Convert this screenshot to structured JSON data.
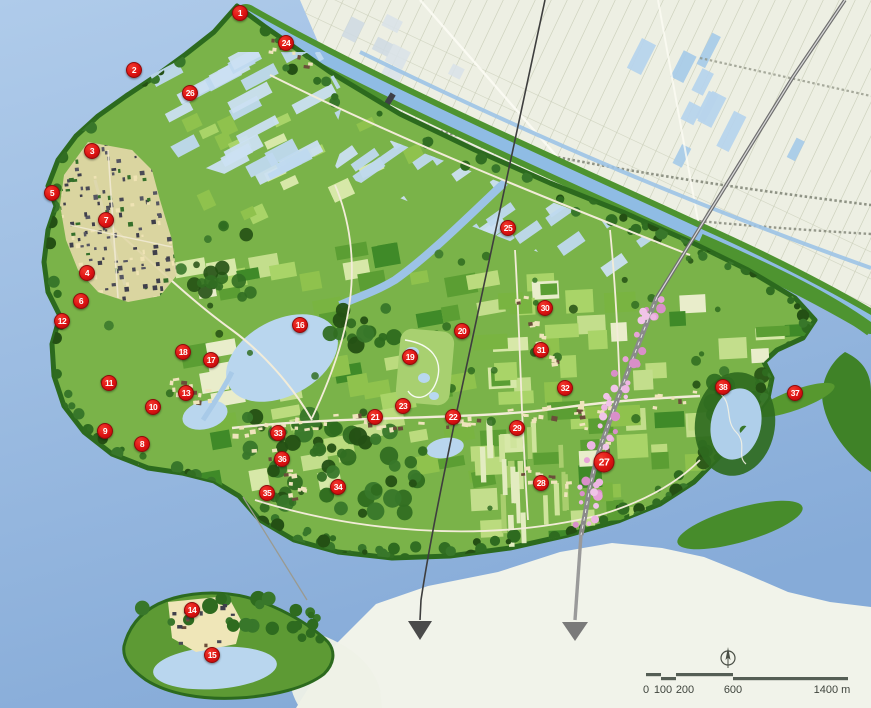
{
  "map": {
    "colors": {
      "sea_top": "#AFCBEA",
      "sea_bottom": "#86ABD8",
      "sand_flat": "#F1F3EA",
      "polder": "#EDEFE3",
      "polder_line": "#C9CDB8",
      "island_green": "#7AB349",
      "field_dark_green": "#3F8A28",
      "forest_green": "#2E6B1F",
      "canal_bank_green": "#4E9430",
      "water_parcel_blue": "#BFD9EF",
      "lake_blue": "#B9D6EE",
      "town_dark": "#4A4A55",
      "village_cream": "#EFE4BC",
      "road_gray": "#8A8A8A",
      "blossom_pink": "#E9A8DB",
      "marker_red": "#DD1212"
    },
    "markers": [
      {
        "label": "1",
        "x": 240,
        "y": 13
      },
      {
        "label": "2",
        "x": 134,
        "y": 70
      },
      {
        "label": "3",
        "x": 92,
        "y": 151
      },
      {
        "label": "4",
        "x": 87,
        "y": 273
      },
      {
        "label": "5",
        "x": 52,
        "y": 193
      },
      {
        "label": "6",
        "x": 81,
        "y": 301
      },
      {
        "label": "7",
        "x": 106,
        "y": 220
      },
      {
        "label": "8",
        "x": 142,
        "y": 444
      },
      {
        "label": "9",
        "x": 105,
        "y": 431
      },
      {
        "label": "10",
        "x": 153,
        "y": 407
      },
      {
        "label": "11",
        "x": 109,
        "y": 383
      },
      {
        "label": "12",
        "x": 62,
        "y": 321
      },
      {
        "label": "13",
        "x": 186,
        "y": 393
      },
      {
        "label": "14",
        "x": 192,
        "y": 610
      },
      {
        "label": "15",
        "x": 212,
        "y": 655
      },
      {
        "label": "16",
        "x": 300,
        "y": 325
      },
      {
        "label": "17",
        "x": 211,
        "y": 360
      },
      {
        "label": "18",
        "x": 183,
        "y": 352
      },
      {
        "label": "19",
        "x": 410,
        "y": 357
      },
      {
        "label": "20",
        "x": 462,
        "y": 331
      },
      {
        "label": "21",
        "x": 375,
        "y": 417
      },
      {
        "label": "22",
        "x": 453,
        "y": 417
      },
      {
        "label": "23",
        "x": 403,
        "y": 406
      },
      {
        "label": "24",
        "x": 286,
        "y": 43
      },
      {
        "label": "25",
        "x": 508,
        "y": 228
      },
      {
        "label": "26",
        "x": 190,
        "y": 93
      },
      {
        "label": "27",
        "x": 604,
        "y": 462
      },
      {
        "label": "28",
        "x": 541,
        "y": 483
      },
      {
        "label": "29",
        "x": 517,
        "y": 428
      },
      {
        "label": "30",
        "x": 545,
        "y": 308
      },
      {
        "label": "31",
        "x": 541,
        "y": 350
      },
      {
        "label": "32",
        "x": 565,
        "y": 388
      },
      {
        "label": "33",
        "x": 278,
        "y": 433
      },
      {
        "label": "34",
        "x": 338,
        "y": 487
      },
      {
        "label": "35",
        "x": 267,
        "y": 493
      },
      {
        "label": "36",
        "x": 282,
        "y": 459
      },
      {
        "label": "37",
        "x": 795,
        "y": 393
      },
      {
        "label": "38",
        "x": 723,
        "y": 387
      }
    ],
    "highlight_marker": "27",
    "scale_bar": {
      "labels": [
        "0",
        "100",
        "200",
        "600"
      ],
      "end_label": "1400 m"
    }
  }
}
